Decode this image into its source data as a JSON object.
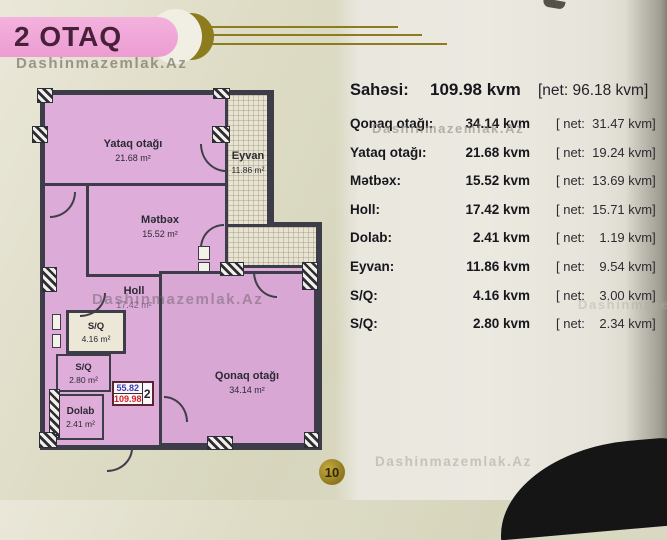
{
  "header": {
    "title": "2 OTAQ"
  },
  "watermark": {
    "text": "Dashinmazemlak.Az"
  },
  "summary": {
    "label": "Sahəsi:",
    "value": "109.98 kvm",
    "net": "[net: 96.18 kvm]"
  },
  "rows": [
    {
      "label": "Qonaq otağı:",
      "value": "34.14 kvm",
      "net": "[ net:  31.47 kvm]"
    },
    {
      "label": "Yataq otağı:",
      "value": "21.68 kvm",
      "net": "[ net:  19.24 kvm]"
    },
    {
      "label": "Mətbəx:",
      "value": "15.52 kvm",
      "net": "[ net:  13.69 kvm]"
    },
    {
      "label": "Holl:",
      "value": "17.42 kvm",
      "net": "[ net:  15.71 kvm]"
    },
    {
      "label": "Dolab:",
      "value": "2.41 kvm",
      "net": "[ net:    1.19 kvm]"
    },
    {
      "label": "Eyvan:",
      "value": "11.86 kvm",
      "net": "[ net:    9.54 kvm]"
    },
    {
      "label": "S/Q:",
      "value": "4.16 kvm",
      "net": "[ net:    3.00 kvm]"
    },
    {
      "label": "S/Q:",
      "value": "2.80 kvm",
      "net": "[ net:    2.34 kvm]"
    }
  ],
  "plan": {
    "rooms": [
      {
        "name": "Yataq otağı",
        "area": "21.68 m²"
      },
      {
        "name": "Eyvan",
        "area": "11.86 m²"
      },
      {
        "name": "Mətbəx",
        "area": "15.52 m²"
      },
      {
        "name": "Holl",
        "area": "17.42 m²"
      },
      {
        "name": "S/Q",
        "area": "4.16 m²"
      },
      {
        "name": "S/Q",
        "area": "2.80 m²"
      },
      {
        "name": "Dolab",
        "area": "2.41 m²"
      },
      {
        "name": "Qonaq otağı",
        "area": "34.14 m²"
      }
    ],
    "unit_box": {
      "net_area": "55.82",
      "total_area": "109.98",
      "unit_number": "2"
    }
  },
  "page_badge": {
    "number": "10"
  },
  "colors": {
    "pill_pink": "#ec9cd2",
    "plan_pink": "#dcabd8",
    "gold": "#8d7c1e",
    "net_blue": "#3a3ab8",
    "total_red": "#d42222"
  }
}
